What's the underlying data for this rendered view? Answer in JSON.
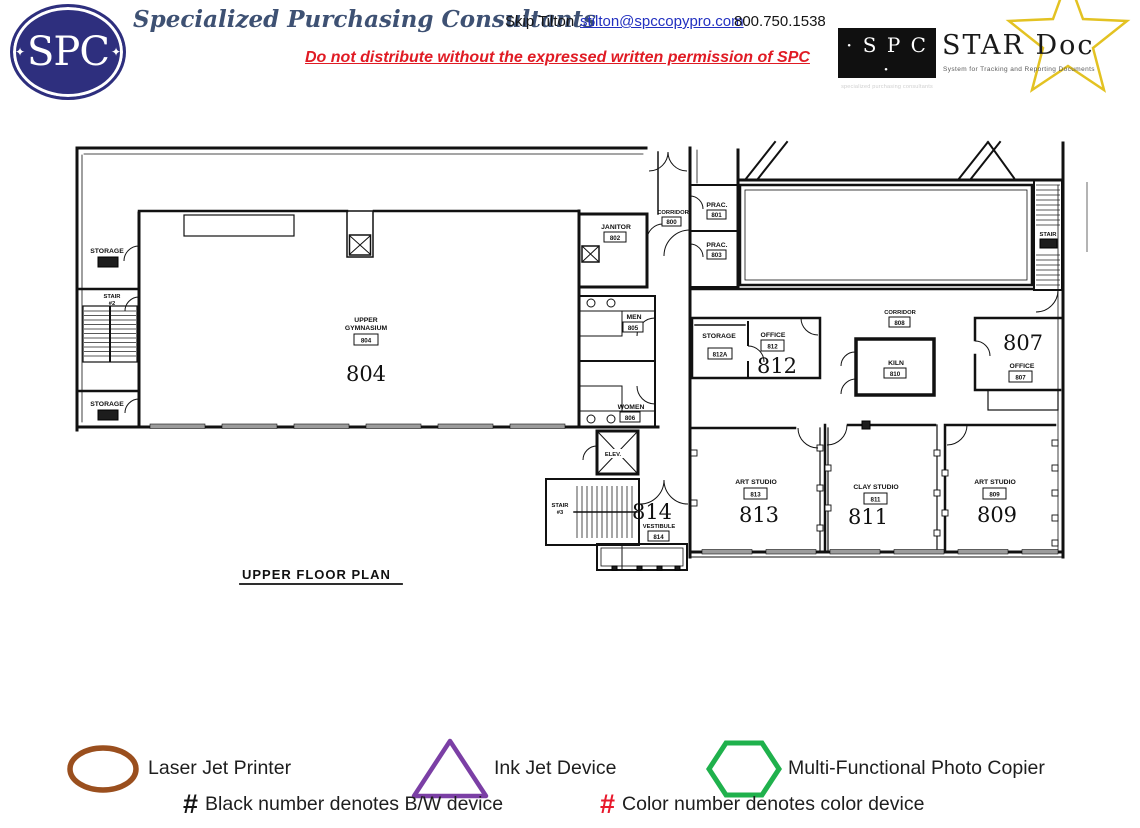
{
  "header": {
    "logo": {
      "text": "SPC",
      "diamond": "✦"
    },
    "company_name": "Specialized Purchasing Consultants",
    "contact_name": "Skip Tilton",
    "email": "stilton@spccopypro.com",
    "phone": "800.750.1538",
    "distribution_warning": "Do not distribute without the expressed written permission of SPC",
    "stardoc": {
      "spc_text": "· S P C ·",
      "spc_subtext": "specialized purchasing consultants",
      "name": "STAR Doc",
      "tagline": "System for Tracking and Reporting Documents"
    }
  },
  "floor_plan": {
    "title": "UPPER FLOOR PLAN",
    "rooms": {
      "storage_nw": {
        "name": "STORAGE"
      },
      "stair_2": {
        "name": "STAIR",
        "number_label": "#2"
      },
      "storage_sw": {
        "name": "STORAGE"
      },
      "upper_gymnasium": {
        "name_line1": "UPPER",
        "name_line2": "GYMNASIUM",
        "room_box": "804",
        "device_number": "804"
      },
      "janitor": {
        "name": "JANITOR",
        "room_box": "802"
      },
      "corridor_800": {
        "name": "CORRIDOR",
        "room_box": "800"
      },
      "prac_801": {
        "name": "PRAC.",
        "room_box": "801"
      },
      "prac_803": {
        "name": "PRAC.",
        "room_box": "803"
      },
      "men": {
        "name": "MEN",
        "room_box": "805"
      },
      "women": {
        "name": "WOMEN",
        "room_box": "806"
      },
      "elevator": {
        "name": "ELEV."
      },
      "stair_3": {
        "name": "STAIR",
        "number_label": "#3"
      },
      "vestibule": {
        "name": "VESTIBULE",
        "room_box": "814",
        "device_number": "814"
      },
      "stair_ne": {
        "name": "STAIR"
      },
      "corridor_808": {
        "name": "CORRIDOR",
        "room_box": "808"
      },
      "storage_812a": {
        "name": "STORAGE",
        "room_box": "812A"
      },
      "office_812": {
        "name": "OFFICE",
        "room_box": "812",
        "device_number": "812"
      },
      "kiln": {
        "name": "KILN",
        "room_box": "810"
      },
      "office_807": {
        "name": "OFFICE",
        "room_box": "807",
        "device_number": "807"
      },
      "art_studio_813": {
        "name": "ART STUDIO",
        "room_box": "813",
        "device_number": "813"
      },
      "clay_studio_811": {
        "name": "CLAY STUDIO",
        "room_box": "811",
        "device_number": "811"
      },
      "art_studio_809": {
        "name": "ART STUDIO",
        "room_box": "809",
        "device_number": "809"
      }
    }
  },
  "legend": {
    "items": [
      {
        "shape": "ellipse",
        "color": "#9a4f1e",
        "label": "Laser Jet Printer"
      },
      {
        "shape": "triangle",
        "color": "#7b3fa5",
        "label": "Ink Jet Device"
      },
      {
        "shape": "hexagon",
        "color": "#1fb14c",
        "label": "Multi-Functional Photo Copier"
      }
    ],
    "notes": [
      {
        "symbol": "#",
        "symbol_color": "#151515",
        "text": "Black number denotes B/W device"
      },
      {
        "symbol": "#",
        "symbol_color": "#e8192c",
        "text": "Color number denotes color device"
      }
    ]
  }
}
